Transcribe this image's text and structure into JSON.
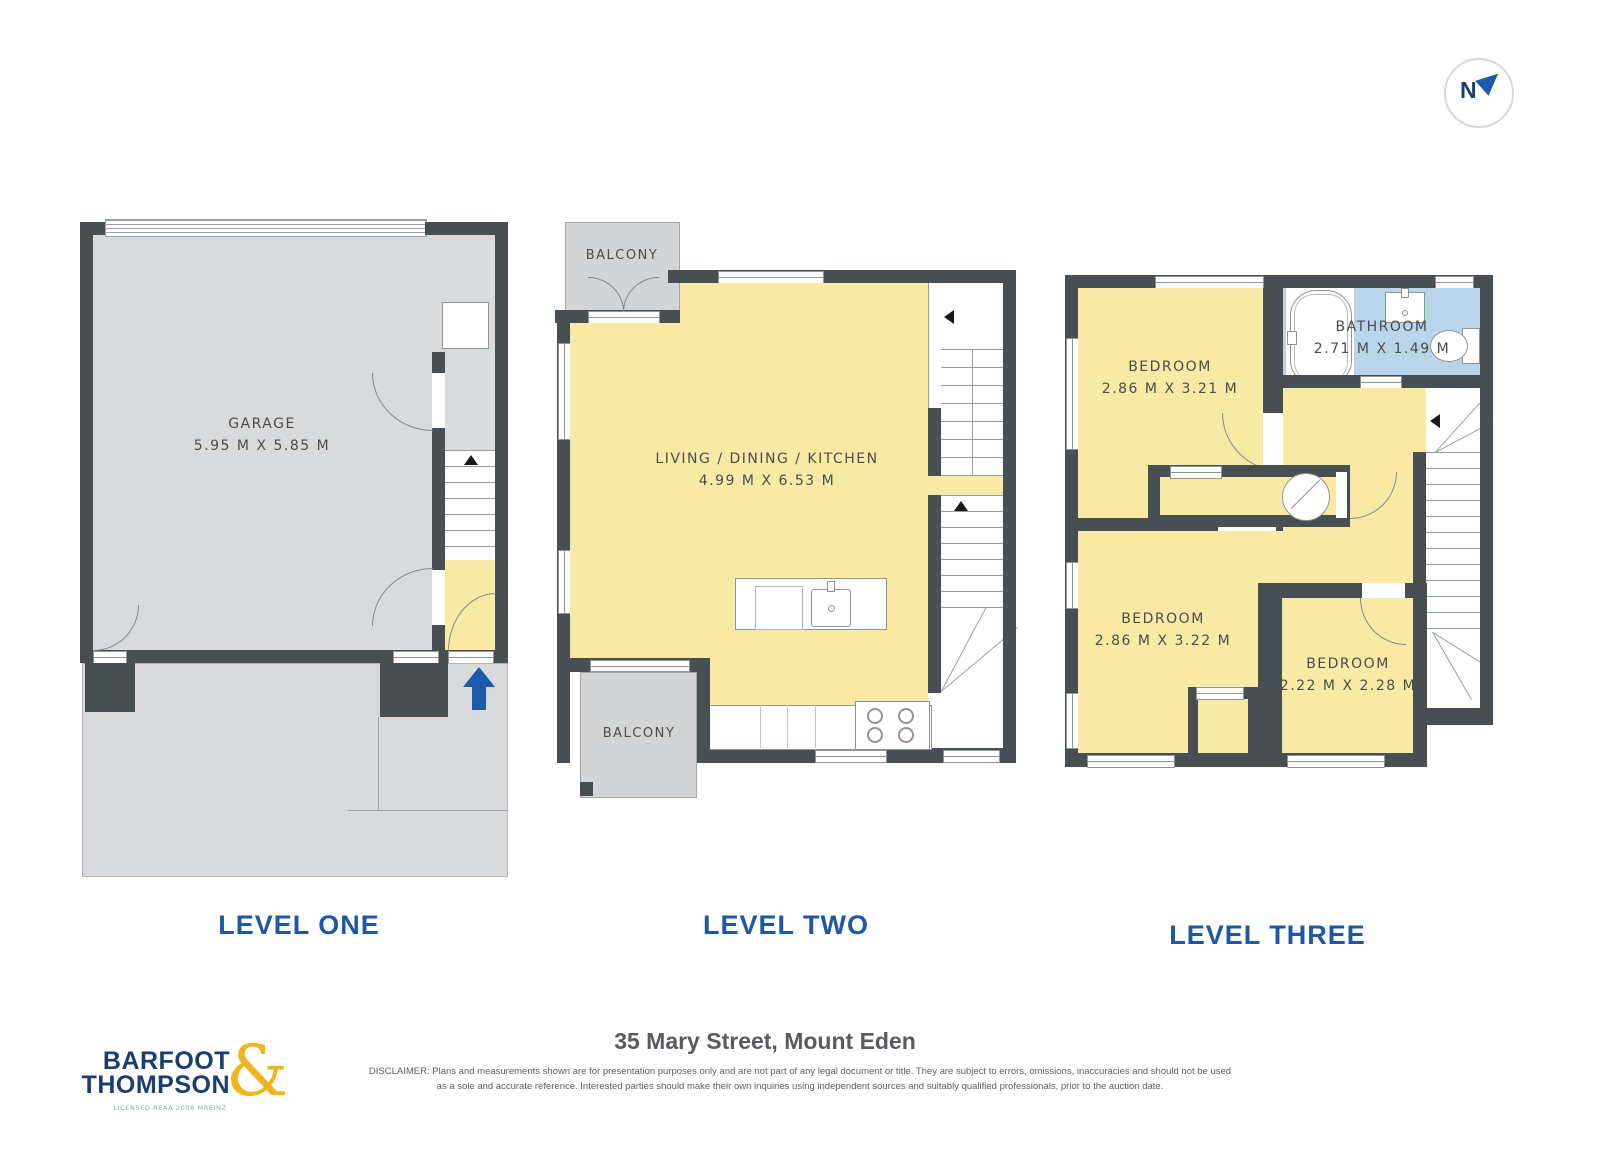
{
  "compass": {
    "label": "N"
  },
  "levels": {
    "one": {
      "title": "LEVEL ONE",
      "garage": {
        "name": "GARAGE",
        "dims": "5.95 M X 5.85 M"
      }
    },
    "two": {
      "title": "LEVEL TWO",
      "living": {
        "name": "LIVING / DINING / KITCHEN",
        "dims": "4.99 M X 6.53 M"
      },
      "balcony_top": {
        "name": "BALCONY"
      },
      "balcony_bottom": {
        "name": "BALCONY"
      }
    },
    "three": {
      "title": "LEVEL THREE",
      "bedroom1": {
        "name": "BEDROOM",
        "dims": "2.86 M X 3.21 M"
      },
      "bathroom": {
        "name": "BATHROOM",
        "dims": "2.71 M X 1.49 M"
      },
      "bedroom2": {
        "name": "BEDROOM",
        "dims": "2.86 M X 3.22 M"
      },
      "bedroom3": {
        "name": "BEDROOM",
        "dims": "2.22 M X 2.28 M"
      }
    }
  },
  "footer": {
    "brand_top": "BARFOOT",
    "brand_bottom": "THOMPSON",
    "brand_amp": "&",
    "brand_license": "LICENSED REAA 2008 MREINZ",
    "address": "35 Mary Street, Mount Eden",
    "disclaimer_l1": "DISCLAIMER: Plans and measurements shown are for presentation purposes only and are not part of any legal document or title. They are subject to errors, omissions, inaccuracies and should not be used",
    "disclaimer_l2": "as a sole and accurate reference. Interested parties should make their own inquiries using independent sources and suitably qualified professionals, prior to the auction date."
  },
  "colors": {
    "wall": "#474f52",
    "floor_yellow": "#f8e9a4",
    "floor_grey": "#d9dadb",
    "floor_blue": "#b9d5ea",
    "balcony_grey": "#d2d4d5",
    "accent_blue": "#1d5aa9",
    "title_blue": "#1d57a8",
    "brand_navy": "#1b3e70",
    "brand_gold": "#f0b51e"
  }
}
